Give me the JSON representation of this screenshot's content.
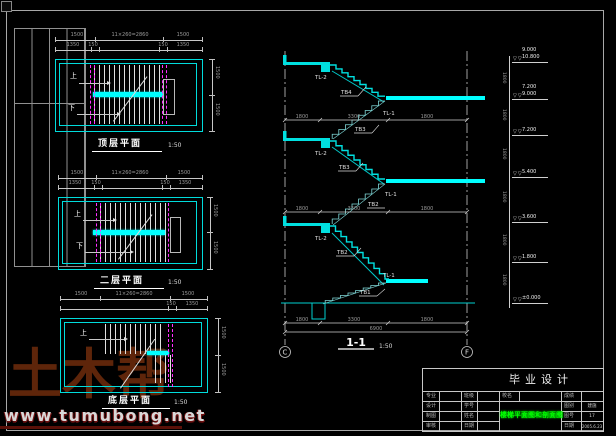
{
  "watermark": {
    "brand": "土木帮",
    "url": "www.tumubong.net"
  },
  "plans": [
    {
      "title": "顶层平面",
      "scale": "1:50",
      "up": "上",
      "down": "下",
      "dims": {
        "top1": [
          "1500",
          "11×260=2860",
          "1500"
        ],
        "top2": [
          "1350",
          "150",
          "150",
          "1350"
        ],
        "right": [
          "1500",
          "1500"
        ]
      }
    },
    {
      "title": "二层平面",
      "scale": "1:50",
      "up": "上",
      "down": "下",
      "dims": {
        "top1": [
          "1500",
          "11×260=2860",
          "1500"
        ],
        "top2": [
          "1350",
          "150",
          "150",
          "1350"
        ],
        "right": [
          "1500",
          "1500"
        ]
      }
    },
    {
      "title": "底层平面",
      "scale": "1:50",
      "up": "上",
      "dims": {
        "top1": [
          "1500",
          "11×260=2860",
          "1500"
        ],
        "top2": [
          "150",
          "1350"
        ],
        "right": [
          "1500",
          "1500"
        ]
      }
    }
  ],
  "section": {
    "title": "1-1",
    "scale": "1:50",
    "bubble_left": "C",
    "bubble_right": "F",
    "beam_floor": "TL-2",
    "beam_landing": "TL-1",
    "flights": [
      "TB4",
      "TB3",
      "TB3",
      "TB2",
      "TB2",
      "TB1"
    ],
    "dims": {
      "upper": [
        "1800",
        "3300",
        "1800"
      ],
      "mid": [
        "1800",
        "3300",
        "1800"
      ],
      "bottom": [
        "1800",
        "3300",
        "1800"
      ],
      "total": "6900"
    }
  },
  "elevation": {
    "marker": "▽▽",
    "step_dim": "1800",
    "levels": [
      {
        "value": "10.800",
        "upper": "9.000"
      },
      {
        "value": "9.000",
        "upper": "7.200"
      },
      {
        "value": "7.200"
      },
      {
        "value": "5.400"
      },
      {
        "value": "3.600"
      },
      {
        "value": "1.800"
      },
      {
        "value": "±0.000"
      }
    ]
  },
  "titleblock": {
    "project": "毕业设计",
    "drawing_name": "楼梯平面图和剖面图",
    "center_label": "校名",
    "left_rows": [
      {
        "l1": "专业",
        "v1": "",
        "l2": "班级",
        "v2": ""
      },
      {
        "l1": "设计",
        "v1": "",
        "l2": "学号",
        "v2": ""
      },
      {
        "l1": "制图",
        "v1": "",
        "l2": "姓名",
        "v2": ""
      },
      {
        "l1": "审核",
        "v1": "",
        "l2": "日期",
        "v2": ""
      }
    ],
    "right_rows": [
      {
        "label": "成绩",
        "value": ""
      },
      {
        "label": "图别",
        "value": "建施"
      },
      {
        "label": "图号",
        "value": "17"
      },
      {
        "label": "日期",
        "value": "2005.6.23"
      }
    ]
  }
}
